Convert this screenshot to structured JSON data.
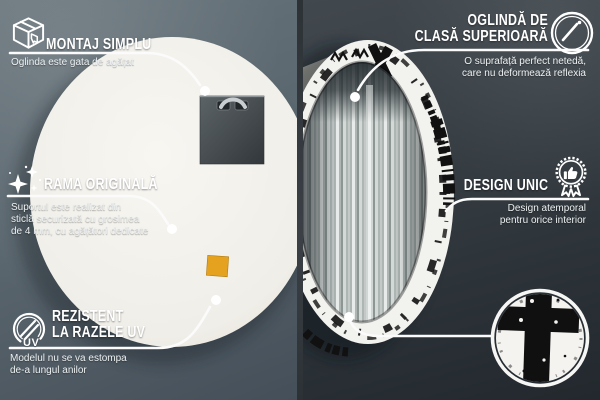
{
  "callouts": {
    "montaj": {
      "icon": "package-box-icon",
      "title": "MONTAJ SIMPLU",
      "desc": "Oglinda este gata de agățat"
    },
    "clasa": {
      "icon": "mirror-shine-icon",
      "title1": "OGLINDĂ DE",
      "title2": "CLASĂ SUPERIOARĂ",
      "desc1": "O suprafață perfect netedă,",
      "desc2": "care nu deformează reflexia"
    },
    "rama": {
      "icon": "sparkles-icon",
      "title": "RAMA ORIGINALĂ",
      "desc1": "Suportul este realizat din",
      "desc2": "sticlă securizată cu grosimea",
      "desc3": "de 4 mm, cu agățători dedicate"
    },
    "design": {
      "icon": "award-badge-icon",
      "title": "DESIGN UNIC",
      "desc1": "Design atemporal",
      "desc2": "pentru orice interior"
    },
    "uv": {
      "icon": "uv-circle-icon",
      "icon_text": "UV",
      "title1": "REZISTENT",
      "title2": "LA RAZELE UV",
      "desc1": "Modelul nu se va estompa",
      "desc2": "de-a lungul anilor"
    }
  },
  "colors": {
    "background_left": "#5b6770",
    "background_right": "#343b41",
    "divider": "#31373c",
    "text": "#ffffff",
    "mirror_back": "#f1efe9",
    "sticker_accent": "#e2a21f",
    "pattern_ink": "#111111"
  }
}
